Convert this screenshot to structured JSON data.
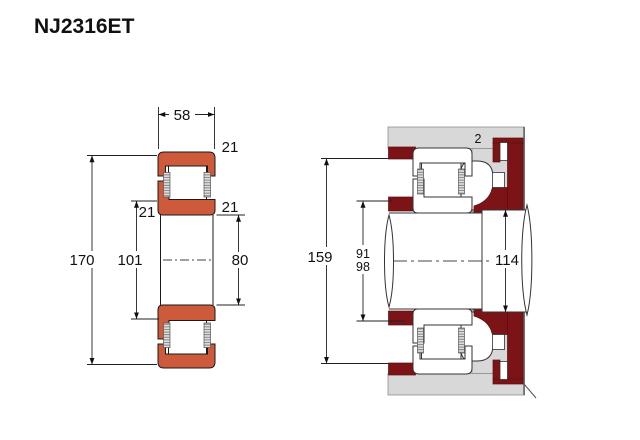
{
  "title": "NJ2316ET",
  "colors": {
    "ring_fill": "#ce5a3c",
    "abutment_fill": "#7c1417",
    "housing_fill": "#d8d8d8",
    "outline": "#1a1a1a",
    "steel_outline": "#333333"
  },
  "left_view": {
    "width_label": "58",
    "outside_diameter_label": "170",
    "rib_diameter_label": "101",
    "bore_diameter_label": "80",
    "corner_top_right_label": "21",
    "corner_mid_left_label": "21",
    "corner_mid_right_label": "21"
  },
  "right_view": {
    "housing_abutment_label": "159",
    "shaft_abutment_upper_label": "91",
    "shaft_abutment_lower_label": "98",
    "shoulder_diameter_label": "114",
    "clearance_label": "2"
  }
}
